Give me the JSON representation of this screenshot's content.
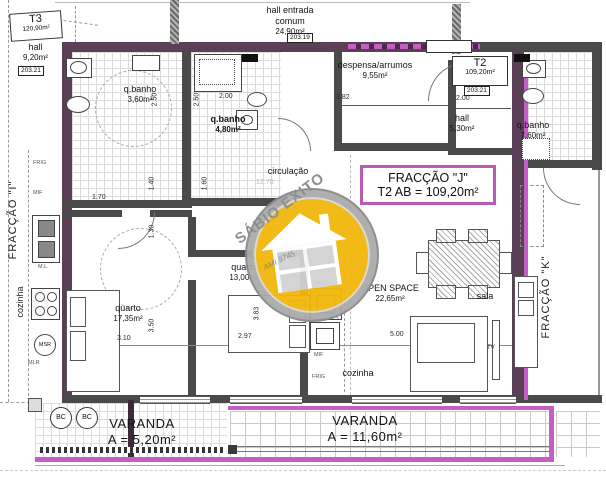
{
  "header": {
    "t3_label": "T3",
    "t3_area": "120,90m²",
    "ref_left": "203.21",
    "entry_line1": "hall entrada",
    "entry_line2": "comum",
    "entry_area": "24,90m²",
    "entry_ref": "203.19",
    "t2_label": "T2",
    "t2_area": "109,20m²",
    "t2_ref": "203.21"
  },
  "fraction_j_box": {
    "title": "FRACÇÃO \"J\"",
    "subtitle": "T2 AB = 109,20m²"
  },
  "neighbors": {
    "left": "FRACÇÃO \"I\"",
    "right": "FRACÇÃO \"K\""
  },
  "rooms": {
    "hall_i": {
      "name": "hall",
      "area": "9,20m²"
    },
    "qbanho_i": {
      "name": "q.banho",
      "area": "3,60m²"
    },
    "qbanho_j": {
      "name": "q.banho",
      "area": "4,80m²"
    },
    "despensa": {
      "name": "despensa/arrumos",
      "area": "9,55m²"
    },
    "hall_j": {
      "name": "hall",
      "area": "5,30m²"
    },
    "qbanho_k": {
      "name": "q.banho",
      "area": "7,60m²"
    },
    "circulacao": {
      "name": "circulação"
    },
    "quarto_1": {
      "name": "quarto",
      "area": "17,35m²"
    },
    "quarto_2": {
      "name": "quarto",
      "area": "13,00m²"
    },
    "open_space": {
      "name": "OPEN SPACE",
      "area": "22,65m²"
    },
    "sala": {
      "name": "sala"
    },
    "cozinha_i": {
      "name": "cozinha"
    },
    "cozinha_j": {
      "name": "cozinha"
    },
    "tv_label": "TV"
  },
  "varandas": {
    "left": {
      "name": "VARANDA",
      "area": "A = 5,20m²"
    },
    "right": {
      "name": "VARANDA",
      "area": "A = 11,60m²"
    },
    "bc": "BC"
  },
  "dims": {
    "despensa_w": "3.82",
    "hall_j_w": "2.00",
    "qbanho_j_w": "2.00",
    "qbanho_j_h": "2.50",
    "qbanho_i_h": "2.50",
    "circ_a": "1.40",
    "circ_b": "1.60",
    "circ_c": "1.30",
    "circ_len": "12.70",
    "kitchen_i_w": "1.70",
    "quarto1_w": "3.10",
    "quarto1_h": "3.50",
    "quarto2_w": "2.97",
    "quarto2_h": "3.83",
    "open_w": "5.00"
  },
  "appliances": {
    "frig_i": "FRIG",
    "mif_i": "MIF",
    "ml_i": "M.L.",
    "msr": "MSR",
    "mlr": "MLR",
    "ml_j": "M.L.",
    "mif_j": "MIF",
    "frig_j": "FRIG"
  },
  "watermark": {
    "brand": "SÁBIO ÊXITO",
    "license": "AMI 9745"
  },
  "colors": {
    "boundary_purple": "#5a3f57",
    "highlight_magenta": "#c55fc5",
    "wall_gray": "#4a4a4a",
    "logo_yellow": "#f2b70a"
  }
}
